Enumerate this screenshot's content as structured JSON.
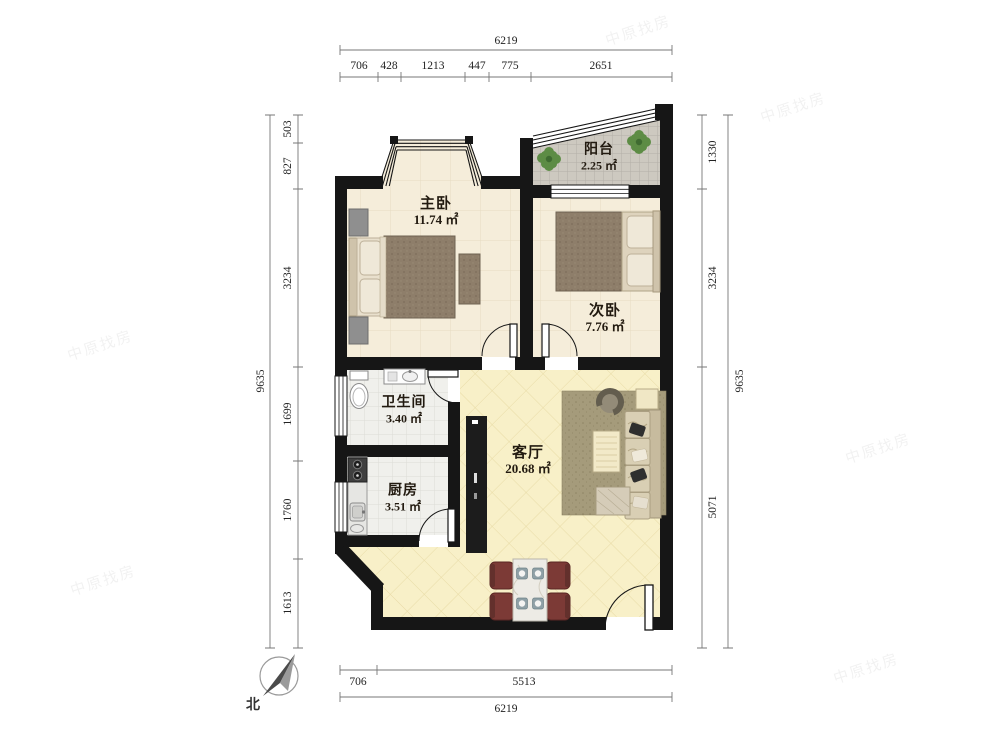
{
  "rooms": {
    "master": {
      "name": "主卧",
      "area": "11.74 ㎡"
    },
    "second": {
      "name": "次卧",
      "area": "7.76 ㎡"
    },
    "balcony": {
      "name": "阳台",
      "area": "2.25 ㎡"
    },
    "bathroom": {
      "name": "卫生间",
      "area": "3.40 ㎡"
    },
    "kitchen": {
      "name": "厨房",
      "area": "3.51 ㎡"
    },
    "living": {
      "name": "客厅",
      "area": "20.68 ㎡"
    }
  },
  "dims": {
    "top": {
      "total": "6219",
      "segs": [
        "706",
        "428",
        "1213",
        "447",
        "775",
        "2651"
      ]
    },
    "bottom": {
      "total": "6219",
      "segs": [
        "706",
        "5513"
      ]
    },
    "left": {
      "total": "9635",
      "segs": [
        "503",
        "827",
        "3234",
        "1699",
        "1760",
        "1613"
      ]
    },
    "right": {
      "total": "9635",
      "segs": [
        "1330",
        "3234",
        "5071"
      ]
    }
  },
  "compass": {
    "north_label": "北"
  },
  "watermark": {
    "text": "中原找房"
  },
  "icons": {
    "compass_needle": "north-arrow",
    "balcony_plants": "potted-plant"
  },
  "colors": {
    "wall": "#161616",
    "bedroom_floor": "#f5edda",
    "living_floor": "#f8f0c8",
    "tile_floor": "#f0f0ec",
    "balcony_floor": "#cdc9c0",
    "chair": "#7c3a36",
    "blanket": "#8e7e6a"
  }
}
